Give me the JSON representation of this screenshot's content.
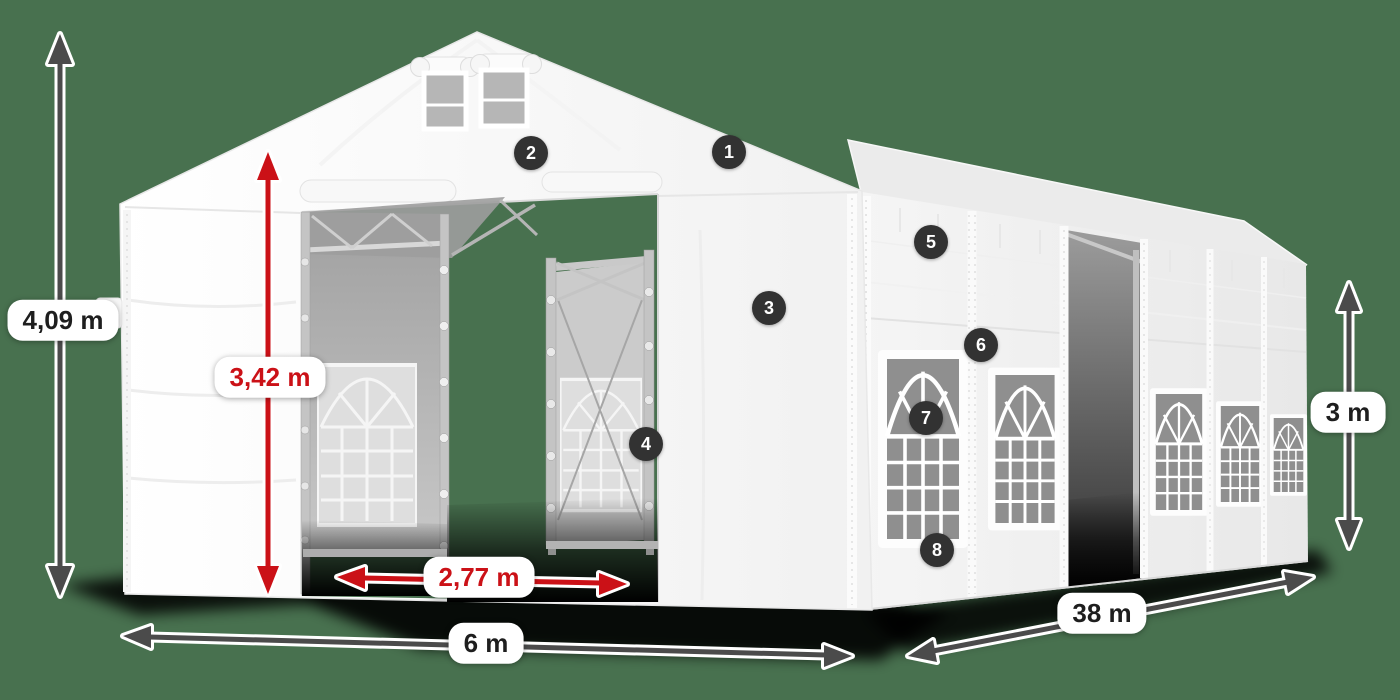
{
  "scene": {
    "colors": {
      "background": "#48714f",
      "dimension_red": "#cb1117",
      "dimension_dark": "#4b4b4b",
      "badge_background": "#323232",
      "tent_white": "#f7f7f7"
    }
  },
  "dimensions": {
    "total_height": {
      "value": "4,09 m"
    },
    "clear_entrance_height": {
      "value": "3,42 m"
    },
    "entrance_width": {
      "value": "2,77 m"
    },
    "front_width": {
      "value": "6 m"
    },
    "side_length": {
      "value": "38 m"
    },
    "side_wall_height": {
      "value": "3 m"
    }
  },
  "callouts": {
    "numbers": [
      "1",
      "2",
      "3",
      "4",
      "5",
      "6",
      "7",
      "8"
    ]
  }
}
